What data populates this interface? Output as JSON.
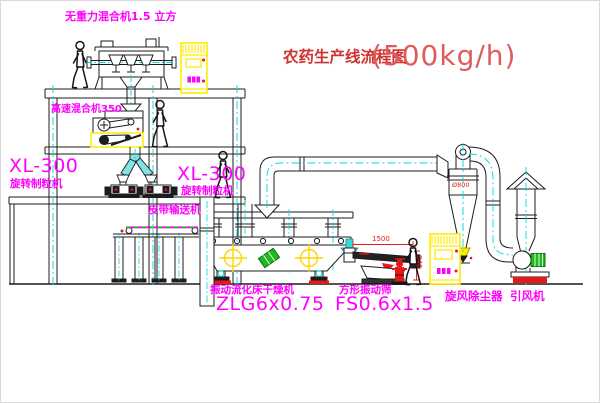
{
  "title": {
    "main": "农药生产线流程图",
    "capacity": "(500kg/h)"
  },
  "labels": {
    "gravity_mixer": "无重力混合机1.5 立方",
    "high_speed_mixer": "高速混合机350",
    "granulator_left_model": "XL-300",
    "granulator_left_name": "旋转制粒机",
    "granulator_right_model": "XL-300",
    "granulator_right_name": "旋转制粒机",
    "belt_conveyor": "皮带输送机",
    "dryer_name": "振动流化床干燥机",
    "dryer_model": "ZLG6x0.75",
    "sieve_name": "方形振动筛",
    "sieve_model": "FS0.6x1.5",
    "cyclone": "旋风除尘器",
    "fan": "引风机"
  },
  "dimensions": {
    "sieve_length": "1500",
    "sieve_height": "340",
    "cyclone_diameter": "Ø800"
  },
  "colors": {
    "label_magenta": "#ff00ff",
    "title_red": "#cf3232",
    "line_black": "#1c1c1c",
    "centerline_cyan": "#00d8d8",
    "highlight_yellow": "#ffec00",
    "dimension_red": "#e81818",
    "motor_green": "#22b822"
  }
}
